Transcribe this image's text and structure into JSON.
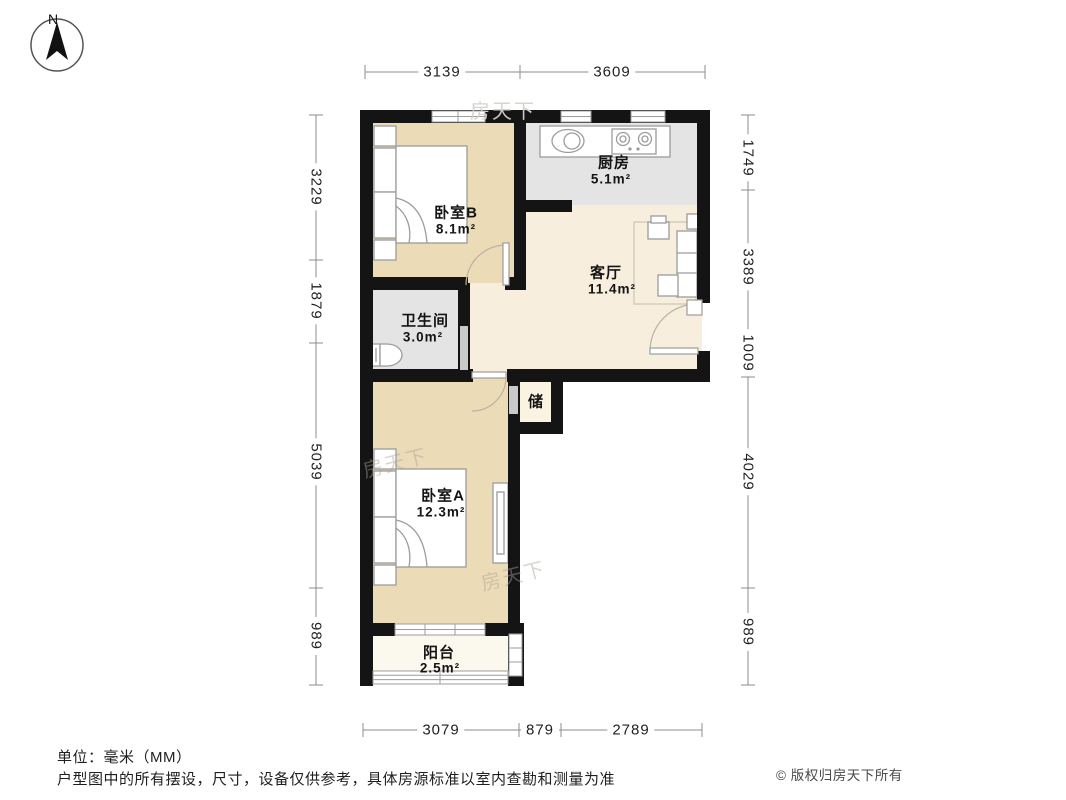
{
  "compass": {
    "north_label": "N"
  },
  "rooms": {
    "bedroom_b": {
      "name": "卧室B",
      "area": "8.1m²"
    },
    "kitchen": {
      "name": "厨房",
      "area": "5.1m²"
    },
    "living": {
      "name": "客厅",
      "area": "11.4m²"
    },
    "bathroom": {
      "name": "卫生间",
      "area": "3.0m²"
    },
    "storage": {
      "name": "储"
    },
    "bedroom_a": {
      "name": "卧室A",
      "area": "12.3m²"
    },
    "balcony": {
      "name": "阳台",
      "area": "2.5m²"
    }
  },
  "dims": {
    "top": [
      "3139",
      "3609"
    ],
    "bottom": [
      "3079",
      "879",
      "2789"
    ],
    "left": [
      "3229",
      "1879",
      "5039",
      "989"
    ],
    "right": [
      "1749",
      "3389",
      "1009",
      "4029",
      "989"
    ]
  },
  "footer": {
    "unit": "单位：毫米（MM）",
    "disclaimer": "户型图中的所有摆设，尺寸，设备仅供参考，具体房源标准以室内查勘和测量为准",
    "copyright": "© 版权归房天下所有"
  },
  "watermark": "房天下",
  "colors": {
    "wall": "#141414",
    "bedroom_fill": "#ecdbb7",
    "kitchen_fill": "#e4e4e4",
    "living_fill": "#f7eedd",
    "storage_fill": "#faf3e1",
    "balcony_fill": "#fbf8ed",
    "door_panel": "#c9c9c9"
  }
}
